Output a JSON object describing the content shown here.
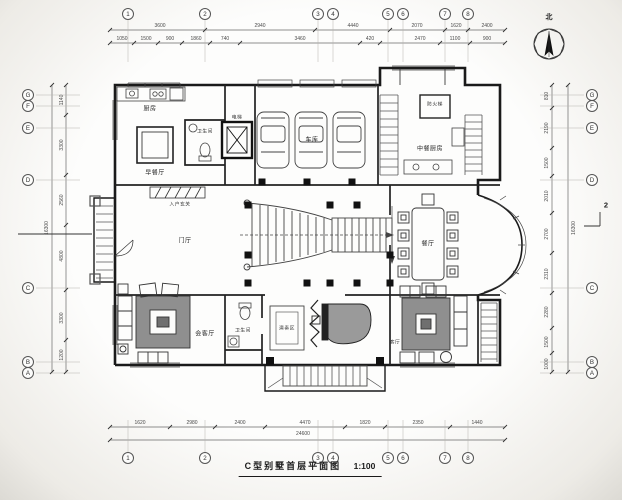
{
  "title": {
    "text": "C型别墅首层平面图",
    "scale": "1:100"
  },
  "compass": {
    "north_label": "北"
  },
  "section_marker": {
    "label": "2"
  },
  "rooms": {
    "kitchen": "厨房",
    "breakfast": "早餐厅",
    "bath1": "卫生间",
    "elevator": "电梯",
    "garage": "车库",
    "chinese_kitchen": "中餐厨房",
    "fire_stair": "防火梯",
    "foyer": "入户玄关",
    "hall": "门厅",
    "dining": "餐厅",
    "reception": "会客厅",
    "bath2": "卫生间",
    "stage": "演奏区",
    "living": "客厅"
  },
  "grid": {
    "top": [
      {
        "x": 128,
        "y": 14,
        "label": "1"
      },
      {
        "x": 205,
        "y": 14,
        "label": "2"
      },
      {
        "x": 318,
        "y": 14,
        "label": "3"
      },
      {
        "x": 333,
        "y": 14,
        "label": "4"
      },
      {
        "x": 388,
        "y": 14,
        "label": "5"
      },
      {
        "x": 403,
        "y": 14,
        "label": "6"
      },
      {
        "x": 445,
        "y": 14,
        "label": "7"
      },
      {
        "x": 468,
        "y": 14,
        "label": "8"
      }
    ],
    "bottom": [
      {
        "x": 128,
        "y": 458,
        "label": "1"
      },
      {
        "x": 205,
        "y": 458,
        "label": "2"
      },
      {
        "x": 318,
        "y": 458,
        "label": "3"
      },
      {
        "x": 333,
        "y": 458,
        "label": "4"
      },
      {
        "x": 388,
        "y": 458,
        "label": "5"
      },
      {
        "x": 403,
        "y": 458,
        "label": "6"
      },
      {
        "x": 445,
        "y": 458,
        "label": "7"
      },
      {
        "x": 468,
        "y": 458,
        "label": "8"
      }
    ],
    "left": [
      {
        "x": 28,
        "y": 95,
        "label": "G"
      },
      {
        "x": 28,
        "y": 106,
        "label": "F"
      },
      {
        "x": 28,
        "y": 128,
        "label": "E"
      },
      {
        "x": 28,
        "y": 180,
        "label": "D"
      },
      {
        "x": 28,
        "y": 288,
        "label": "C"
      },
      {
        "x": 28,
        "y": 362,
        "label": "B"
      },
      {
        "x": 28,
        "y": 373,
        "label": "A"
      }
    ],
    "right": [
      {
        "x": 592,
        "y": 95,
        "label": "G"
      },
      {
        "x": 592,
        "y": 106,
        "label": "F"
      },
      {
        "x": 592,
        "y": 128,
        "label": "E"
      },
      {
        "x": 592,
        "y": 180,
        "label": "D"
      },
      {
        "x": 592,
        "y": 288,
        "label": "C"
      },
      {
        "x": 592,
        "y": 362,
        "label": "B"
      },
      {
        "x": 592,
        "y": 373,
        "label": "A"
      }
    ]
  },
  "dimensions": {
    "top_outer": [
      {
        "x": 160,
        "y": 26,
        "v": "3600"
      },
      {
        "x": 260,
        "y": 26,
        "v": "2940"
      },
      {
        "x": 353,
        "y": 26,
        "v": "4440"
      },
      {
        "x": 417,
        "y": 26,
        "v": "2070"
      },
      {
        "x": 456,
        "y": 26,
        "v": "1620"
      },
      {
        "x": 487,
        "y": 26,
        "v": "2400"
      }
    ],
    "top_inner": [
      {
        "x": 122,
        "y": 39,
        "v": "1050"
      },
      {
        "x": 146,
        "y": 39,
        "v": "1500"
      },
      {
        "x": 170,
        "y": 39,
        "v": "900"
      },
      {
        "x": 196,
        "y": 39,
        "v": "1860"
      },
      {
        "x": 225,
        "y": 39,
        "v": "740"
      },
      {
        "x": 300,
        "y": 39,
        "v": "3460"
      },
      {
        "x": 370,
        "y": 39,
        "v": "420"
      },
      {
        "x": 420,
        "y": 39,
        "v": "2470"
      },
      {
        "x": 455,
        "y": 39,
        "v": "1100"
      },
      {
        "x": 487,
        "y": 39,
        "v": "900"
      }
    ],
    "bottom_inner": [
      {
        "x": 140,
        "y": 423,
        "v": "1620"
      },
      {
        "x": 192,
        "y": 423,
        "v": "2980"
      },
      {
        "x": 240,
        "y": 423,
        "v": "2400"
      },
      {
        "x": 305,
        "y": 423,
        "v": "4470"
      },
      {
        "x": 365,
        "y": 423,
        "v": "1820"
      },
      {
        "x": 418,
        "y": 423,
        "v": "2350"
      },
      {
        "x": 477,
        "y": 423,
        "v": "1440"
      }
    ],
    "bottom_outer": [
      {
        "x": 303,
        "y": 434,
        "v": "24600"
      }
    ],
    "left_chain": [
      {
        "x": 62,
        "y": 100,
        "v": "1140",
        "rot": -90
      },
      {
        "x": 62,
        "y": 145,
        "v": "3300",
        "rot": -90
      },
      {
        "x": 62,
        "y": 200,
        "v": "2560",
        "rot": -90
      },
      {
        "x": 62,
        "y": 256,
        "v": "4800",
        "rot": -90
      },
      {
        "x": 62,
        "y": 318,
        "v": "3300",
        "rot": -90
      },
      {
        "x": 62,
        "y": 355,
        "v": "1200",
        "rot": -90
      }
    ],
    "left_outer": [
      {
        "x": 47,
        "y": 228,
        "v": "16300",
        "rot": -90
      }
    ],
    "right_chain": [
      {
        "x": 547,
        "y": 96,
        "v": "810",
        "rot": -90
      },
      {
        "x": 547,
        "y": 128,
        "v": "2190",
        "rot": -90
      },
      {
        "x": 547,
        "y": 163,
        "v": "1500",
        "rot": -90
      },
      {
        "x": 547,
        "y": 196,
        "v": "2010",
        "rot": -90
      },
      {
        "x": 547,
        "y": 234,
        "v": "2700",
        "rot": -90
      },
      {
        "x": 547,
        "y": 274,
        "v": "2310",
        "rot": -90
      },
      {
        "x": 547,
        "y": 312,
        "v": "2280",
        "rot": -90
      },
      {
        "x": 547,
        "y": 342,
        "v": "1500",
        "rot": -90
      },
      {
        "x": 547,
        "y": 364,
        "v": "1000",
        "rot": -90
      }
    ],
    "right_outer": [
      {
        "x": 574,
        "y": 228,
        "v": "16300",
        "rot": -90
      }
    ]
  }
}
